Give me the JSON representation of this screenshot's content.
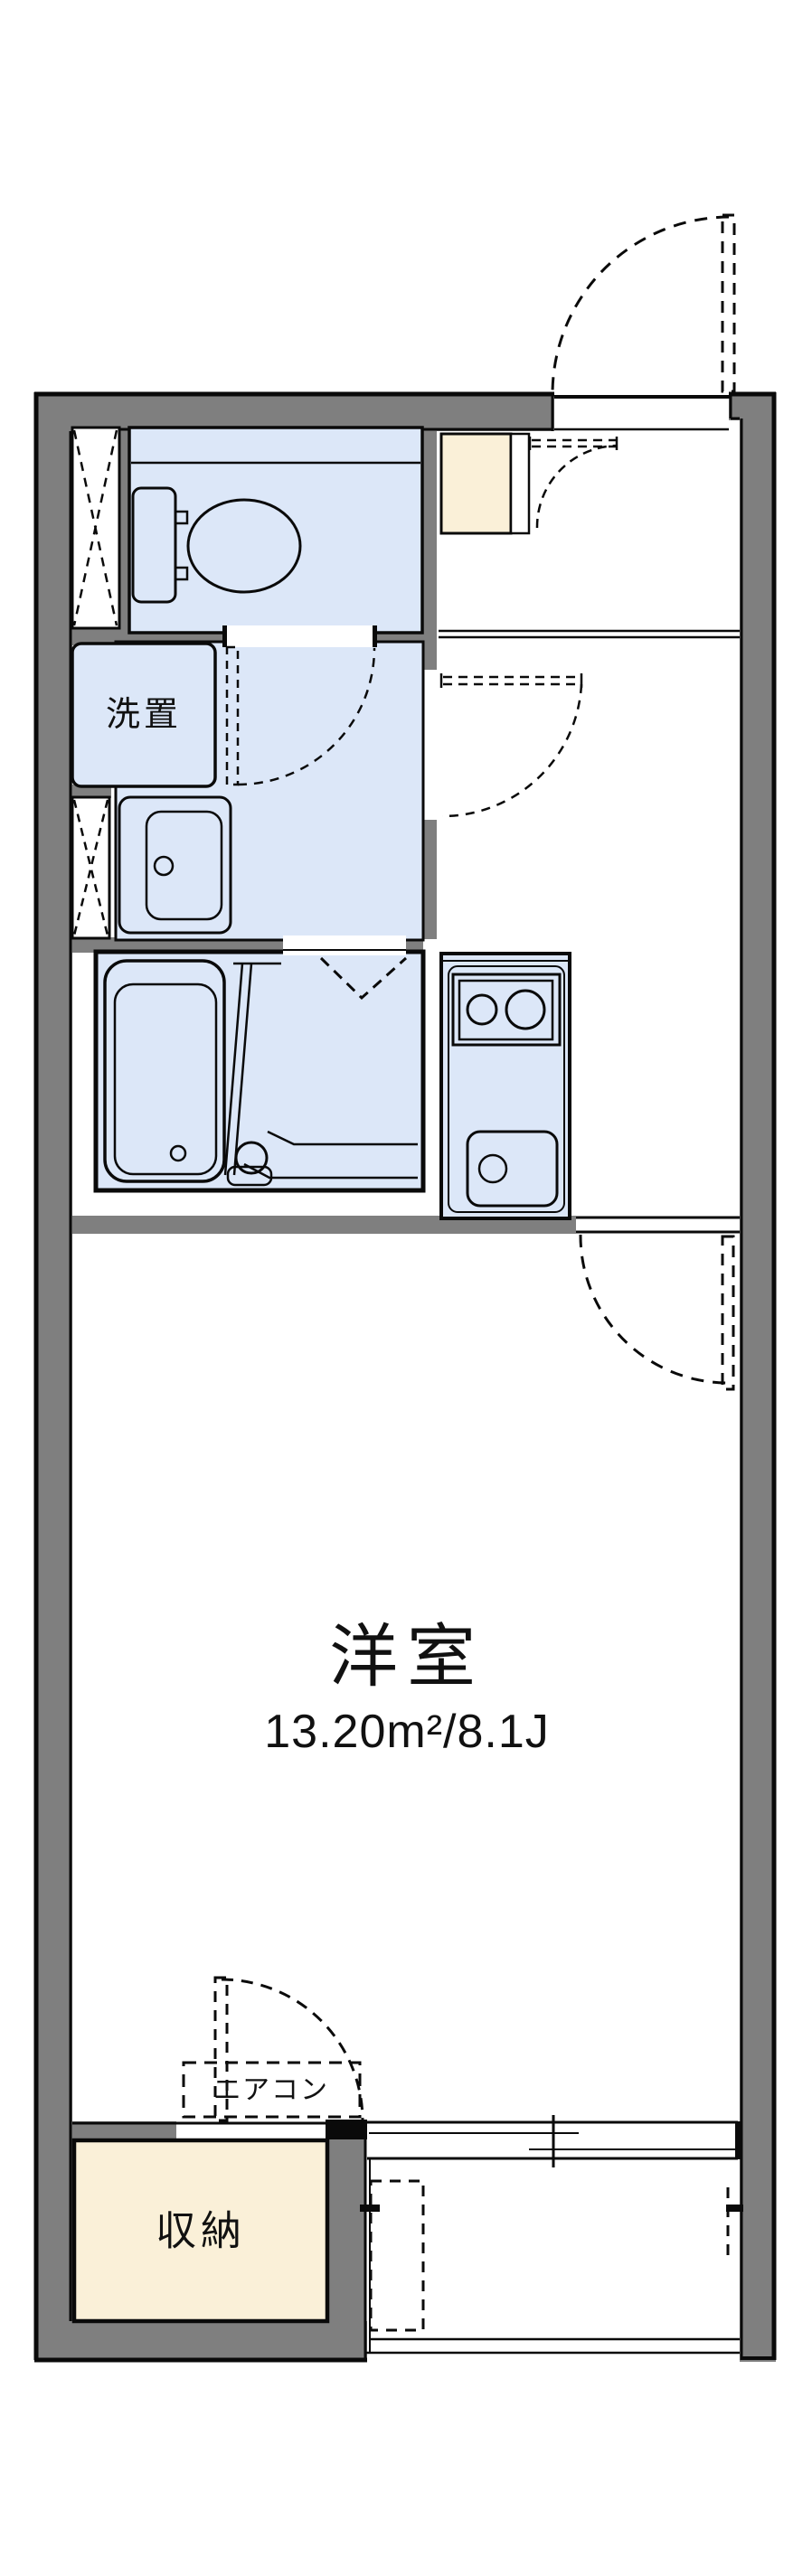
{
  "plan": {
    "type": "apartment-floor-plan",
    "rooms": {
      "main_room": {
        "label": "洋室",
        "area_label": "13.20m²/8.1J"
      },
      "laundry": {
        "label": "洗置"
      },
      "storage": {
        "label": "収納"
      },
      "aircon": {
        "label": "エアコン"
      }
    },
    "colors": {
      "wall": "#7f7f7f",
      "line": "#0a0a0a",
      "room_fill": "#dce7f8",
      "storage_fill": "#faf0d8",
      "background": "#ffffff"
    }
  }
}
